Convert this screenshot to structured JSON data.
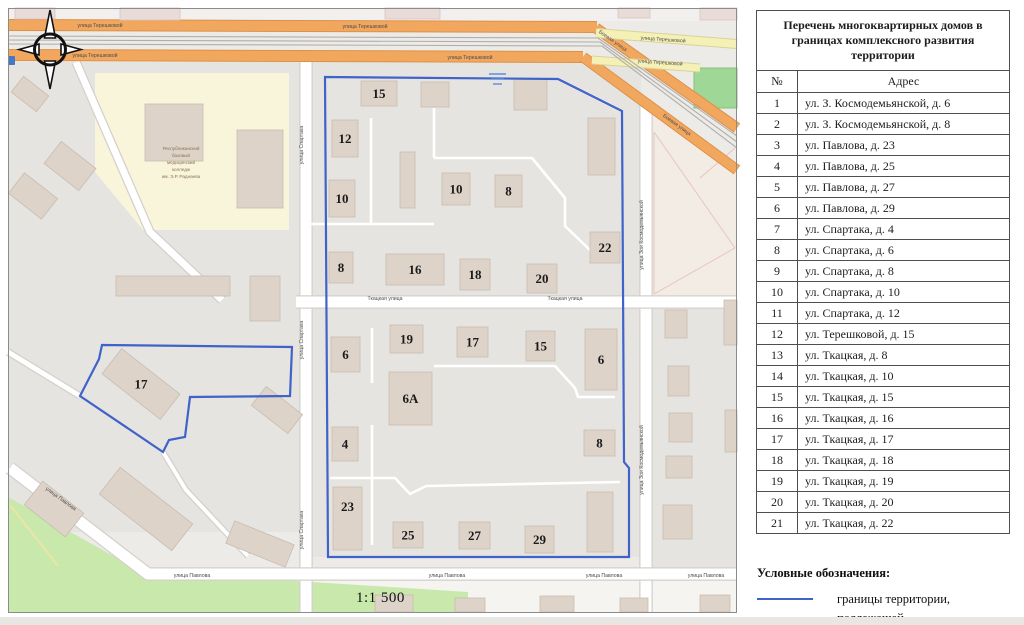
{
  "table": {
    "title": "Перечень многоквартирных домов в границах комплексного развития территории",
    "col_num": "№",
    "col_addr": "Адрес",
    "rows": [
      {
        "n": "1",
        "addr": "ул. З. Космодемьянской, д. 6"
      },
      {
        "n": "2",
        "addr": "ул. З. Космодемьянской, д. 8"
      },
      {
        "n": "3",
        "addr": "ул. Павлова, д. 23"
      },
      {
        "n": "4",
        "addr": "ул. Павлова, д. 25"
      },
      {
        "n": "5",
        "addr": "ул. Павлова, д. 27"
      },
      {
        "n": "6",
        "addr": "ул. Павлова, д. 29"
      },
      {
        "n": "7",
        "addr": "ул. Спартака, д. 4"
      },
      {
        "n": "8",
        "addr": "ул. Спартака, д. 6"
      },
      {
        "n": "9",
        "addr": "ул. Спартака, д. 8"
      },
      {
        "n": "10",
        "addr": "ул. Спартака, д. 10"
      },
      {
        "n": "11",
        "addr": "ул. Спартака, д. 12"
      },
      {
        "n": "12",
        "addr": "ул. Терешковой, д. 15"
      },
      {
        "n": "13",
        "addr": "ул. Ткацкая, д. 8"
      },
      {
        "n": "14",
        "addr": "ул. Ткацкая, д. 10"
      },
      {
        "n": "15",
        "addr": "ул. Ткацкая, д. 15"
      },
      {
        "n": "16",
        "addr": "ул. Ткацкая, д. 16"
      },
      {
        "n": "17",
        "addr": "ул. Ткацкая, д. 17"
      },
      {
        "n": "18",
        "addr": "ул. Ткацкая, д. 18"
      },
      {
        "n": "19",
        "addr": "ул. Ткацкая, д. 19"
      },
      {
        "n": "20",
        "addr": "ул. Ткацкая, д. 20"
      },
      {
        "n": "21",
        "addr": "ул. Ткацкая, д. 22"
      }
    ]
  },
  "legend": {
    "heading": "Условные обозначения:",
    "line1": "границы территории, подлежащей",
    "line2": "комплексному развитию",
    "boundary_color": "#3f63c9"
  },
  "map": {
    "scale_label": "1:1 500",
    "colors": {
      "base": "#edebe8",
      "residential": "#e6e4e1",
      "strip": "#f6f4f1",
      "topstrip": "#f2f0ee",
      "building": "#ddd3c9",
      "buildingStroke": "#c9bcb0",
      "buildingPink": "#e9dbd7",
      "pinkStroke": "#d9c6c2",
      "orange": "#f2a75f",
      "orangeCasing": "#dd9147",
      "yellow": "#f5f1b6",
      "yellowCasing": "#d8d398",
      "white": "#ffffff",
      "casing": "#d4d0cc",
      "rail": "#b1aeab",
      "green": "#c9e8ab",
      "pitch": "#9fd797",
      "collegeArea": "#f8f5da",
      "beige": "#f2ece5",
      "pinkLine": "#e6c3ba",
      "boundary": "#3f63c9",
      "streetLabel": "#4c4c4c",
      "number": "#1b1b1b",
      "collegeText": "#8a7354",
      "poiBlue": "#4576c8"
    },
    "residential": [
      [
        8,
        62,
        294,
        470
      ],
      [
        311,
        62,
        330,
        495
      ],
      [
        652,
        308,
        85,
        262
      ]
    ],
    "college": {
      "outline": [
        [
          95,
          73
        ],
        [
          289,
          73
        ],
        [
          289,
          230
        ],
        [
          143,
          230
        ],
        [
          95,
          172
        ]
      ],
      "label_lines": [
        "Республиканский",
        "базовый",
        "медицинский",
        "колледж",
        "им. Э.Р. Раднаева"
      ],
      "label_x": 181,
      "label_y": 150,
      "line_h": 7
    },
    "ne_area": {
      "outline": [
        [
          640,
          104
        ],
        [
          737,
          174
        ],
        [
          737,
          300
        ],
        [
          652,
          300
        ],
        [
          640,
          236
        ]
      ],
      "lines": [
        [
          [
            654,
            132
          ],
          [
            735,
            248
          ]
        ],
        [
          [
            654,
            294
          ],
          [
            735,
            248
          ]
        ],
        [
          [
            700,
            178
          ],
          [
            735,
            148
          ]
        ],
        [
          [
            654,
            132
          ],
          [
            654,
            294
          ]
        ]
      ]
    },
    "greens": {
      "park": [
        [
          8,
          497
        ],
        [
          140,
          571
        ],
        [
          468,
          592
        ],
        [
          468,
          613
        ],
        [
          8,
          613
        ]
      ],
      "pitch": [
        694,
        68,
        43,
        40
      ],
      "yellow_path": [
        [
          10,
          505
        ],
        [
          58,
          566
        ]
      ]
    },
    "white_streets": [
      {
        "pts": [
          [
            306,
            60
          ],
          [
            306,
            613
          ]
        ],
        "w": 11
      },
      {
        "pts": [
          [
            646,
            104
          ],
          [
            646,
            613
          ]
        ],
        "w": 11
      },
      {
        "pts": [
          [
            296,
            302
          ],
          [
            737,
            302
          ]
        ],
        "w": 11
      },
      {
        "pts": [
          [
            10,
            468
          ],
          [
            148,
            574
          ],
          [
            737,
            574
          ]
        ],
        "w": 11
      },
      {
        "pts": [
          [
            76,
            62
          ],
          [
            150,
            232
          ],
          [
            222,
            300
          ]
        ],
        "w": 7
      },
      {
        "pts": [
          [
            8,
            352
          ],
          [
            80,
            396
          ]
        ],
        "w": 5
      },
      {
        "pts": [
          [
            163,
            452
          ],
          [
            186,
            490
          ],
          [
            248,
            556
          ]
        ],
        "w": 4
      }
    ],
    "inner_paths": [
      [
        [
          310,
          224
        ],
        [
          434,
          224
        ]
      ],
      [
        [
          371,
          118
        ],
        [
          371,
          224
        ]
      ],
      [
        [
          434,
          108
        ],
        [
          434,
          158
        ]
      ],
      [
        [
          434,
          158
        ],
        [
          532,
          158
        ],
        [
          565,
          198
        ],
        [
          565,
          226
        ],
        [
          592,
          252
        ],
        [
          620,
          252
        ]
      ],
      [
        [
          434,
          366
        ],
        [
          555,
          366
        ],
        [
          575,
          388
        ],
        [
          578,
          397
        ],
        [
          615,
          397
        ]
      ],
      [
        [
          372,
          328
        ],
        [
          372,
          383
        ]
      ],
      [
        [
          372,
          425
        ],
        [
          372,
          545
        ]
      ],
      [
        [
          330,
          478
        ],
        [
          395,
          478
        ],
        [
          410,
          494
        ],
        [
          426,
          486
        ],
        [
          620,
          482
        ]
      ]
    ],
    "major_roads": [
      {
        "pts": [
          [
            8,
            25
          ],
          [
            597,
            27
          ]
        ],
        "w": 10,
        "t": "orange"
      },
      {
        "pts": [
          [
            8,
            55
          ],
          [
            583,
            57
          ]
        ],
        "w": 10,
        "t": "orange"
      },
      {
        "pts": [
          [
            596,
            28
          ],
          [
            737,
            128
          ]
        ],
        "w": 9,
        "t": "orange"
      },
      {
        "pts": [
          [
            583,
            57
          ],
          [
            737,
            170
          ]
        ],
        "w": 9,
        "t": "orange"
      },
      {
        "pts": [
          [
            596,
            33
          ],
          [
            737,
            44
          ]
        ],
        "w": 8,
        "t": "yellow"
      },
      {
        "pts": [
          [
            592,
            60
          ],
          [
            700,
            68
          ]
        ],
        "w": 7,
        "t": "yellow"
      }
    ],
    "railway": [
      [
        [
          8,
          36
        ],
        [
          598,
          38
        ],
        [
          737,
          136
        ]
      ],
      [
        [
          8,
          40
        ],
        [
          600,
          42
        ],
        [
          737,
          142
        ]
      ],
      [
        [
          8,
          44
        ],
        [
          602,
          46
        ],
        [
          737,
          148
        ]
      ]
    ],
    "buildings": [
      {
        "x": 361,
        "y": 81,
        "w": 36,
        "h": 25,
        "l": "15"
      },
      {
        "x": 421,
        "y": 82,
        "w": 28,
        "h": 25
      },
      {
        "x": 514,
        "y": 79,
        "w": 33,
        "h": 31
      },
      {
        "x": 332,
        "y": 120,
        "w": 26,
        "h": 37,
        "l": "12"
      },
      {
        "x": 400,
        "y": 152,
        "w": 15,
        "h": 56
      },
      {
        "x": 442,
        "y": 173,
        "w": 28,
        "h": 32,
        "l": "10"
      },
      {
        "x": 495,
        "y": 175,
        "w": 27,
        "h": 32,
        "l": "8"
      },
      {
        "x": 588,
        "y": 118,
        "w": 27,
        "h": 57
      },
      {
        "x": 329,
        "y": 180,
        "w": 26,
        "h": 37,
        "l": "10"
      },
      {
        "x": 590,
        "y": 232,
        "w": 30,
        "h": 31,
        "l": "22"
      },
      {
        "x": 329,
        "y": 252,
        "w": 24,
        "h": 31,
        "l": "8"
      },
      {
        "x": 386,
        "y": 254,
        "w": 58,
        "h": 31,
        "l": "16"
      },
      {
        "x": 460,
        "y": 259,
        "w": 30,
        "h": 31,
        "l": "18"
      },
      {
        "x": 527,
        "y": 264,
        "w": 30,
        "h": 29,
        "l": "20"
      },
      {
        "x": 331,
        "y": 337,
        "w": 29,
        "h": 35,
        "l": "6"
      },
      {
        "x": 390,
        "y": 325,
        "w": 33,
        "h": 28,
        "l": "19"
      },
      {
        "x": 457,
        "y": 327,
        "w": 31,
        "h": 30,
        "l": "17"
      },
      {
        "x": 526,
        "y": 331,
        "w": 29,
        "h": 30,
        "l": "15"
      },
      {
        "x": 585,
        "y": 329,
        "w": 32,
        "h": 61,
        "l": "6"
      },
      {
        "x": 389,
        "y": 372,
        "w": 43,
        "h": 53,
        "l": "6А"
      },
      {
        "x": 332,
        "y": 427,
        "w": 26,
        "h": 34,
        "l": "4"
      },
      {
        "x": 584,
        "y": 430,
        "w": 31,
        "h": 26,
        "l": "8"
      },
      {
        "x": 333,
        "y": 487,
        "w": 29,
        "h": 63,
        "l": "23",
        "ly": -12
      },
      {
        "x": 393,
        "y": 522,
        "w": 30,
        "h": 26,
        "l": "25"
      },
      {
        "x": 459,
        "y": 522,
        "w": 31,
        "h": 27,
        "l": "27"
      },
      {
        "x": 525,
        "y": 526,
        "w": 29,
        "h": 27,
        "l": "29"
      },
      {
        "x": 587,
        "y": 492,
        "w": 26,
        "h": 60
      },
      {
        "x": 104,
        "y": 368,
        "w": 74,
        "h": 32,
        "l": "17",
        "r": 38
      },
      {
        "x": 12,
        "y": 183,
        "w": 42,
        "h": 26,
        "r": 38
      },
      {
        "x": 48,
        "y": 152,
        "w": 44,
        "h": 28,
        "r": 38
      },
      {
        "x": 14,
        "y": 84,
        "w": 32,
        "h": 20,
        "r": 38
      },
      {
        "x": 116,
        "y": 276,
        "w": 114,
        "h": 20
      },
      {
        "x": 250,
        "y": 276,
        "w": 30,
        "h": 45
      },
      {
        "x": 28,
        "y": 494,
        "w": 52,
        "h": 30,
        "r": 38
      },
      {
        "x": 100,
        "y": 492,
        "w": 92,
        "h": 34,
        "r": 38
      },
      {
        "x": 228,
        "y": 532,
        "w": 64,
        "h": 24,
        "r": 22
      },
      {
        "x": 254,
        "y": 398,
        "w": 46,
        "h": 24,
        "r": 38
      },
      {
        "x": 145,
        "y": 104,
        "w": 58,
        "h": 57
      },
      {
        "x": 237,
        "y": 130,
        "w": 46,
        "h": 78
      },
      {
        "x": 665,
        "y": 310,
        "w": 22,
        "h": 28
      },
      {
        "x": 668,
        "y": 366,
        "w": 21,
        "h": 30
      },
      {
        "x": 669,
        "y": 413,
        "w": 23,
        "h": 29
      },
      {
        "x": 666,
        "y": 456,
        "w": 26,
        "h": 22
      },
      {
        "x": 663,
        "y": 505,
        "w": 29,
        "h": 34
      },
      {
        "x": 724,
        "y": 300,
        "w": 13,
        "h": 45
      },
      {
        "x": 725,
        "y": 410,
        "w": 12,
        "h": 42
      },
      {
        "x": 375,
        "y": 595,
        "w": 38,
        "h": 17
      },
      {
        "x": 455,
        "y": 598,
        "w": 30,
        "h": 14
      },
      {
        "x": 540,
        "y": 596,
        "w": 34,
        "h": 16
      },
      {
        "x": 620,
        "y": 598,
        "w": 28,
        "h": 14
      },
      {
        "x": 700,
        "y": 595,
        "w": 30,
        "h": 17
      },
      {
        "x": 15,
        "y": 8,
        "w": 40,
        "h": 11,
        "c": "pink"
      },
      {
        "x": 120,
        "y": 8,
        "w": 60,
        "h": 12,
        "c": "pink"
      },
      {
        "x": 385,
        "y": 8,
        "w": 55,
        "h": 11,
        "c": "pink"
      },
      {
        "x": 618,
        "y": 8,
        "w": 32,
        "h": 10,
        "c": "pink"
      },
      {
        "x": 700,
        "y": 8,
        "w": 37,
        "h": 12,
        "c": "pink"
      }
    ],
    "street_labels": [
      {
        "t": "улица Терешковой",
        "x": 100,
        "y": 27,
        "r": 0
      },
      {
        "t": "улица Терешковой",
        "x": 365,
        "y": 28,
        "r": 0
      },
      {
        "t": "улица Терешковой",
        "x": 95,
        "y": 57,
        "r": 0
      },
      {
        "t": "улица Терешковой",
        "x": 470,
        "y": 59,
        "r": 0
      },
      {
        "t": "улица Терешковой",
        "x": 663,
        "y": 41,
        "r": 4
      },
      {
        "t": "улица Терешковой",
        "x": 660,
        "y": 64,
        "r": 4
      },
      {
        "t": "Боевая улица",
        "x": 612,
        "y": 42,
        "r": 35
      },
      {
        "t": "Боевая улица",
        "x": 676,
        "y": 126,
        "r": 36
      },
      {
        "t": "улица Спартака",
        "x": 303,
        "y": 145,
        "r": -90
      },
      {
        "t": "улица Спартака",
        "x": 303,
        "y": 340,
        "r": -90
      },
      {
        "t": "улица Спартака",
        "x": 303,
        "y": 530,
        "r": -90
      },
      {
        "t": "улица Зои Космодемьянской",
        "x": 643,
        "y": 235,
        "r": -90
      },
      {
        "t": "улица Зои Космодемьянской",
        "x": 643,
        "y": 460,
        "r": -90
      },
      {
        "t": "Ткацкая улица",
        "x": 385,
        "y": 300,
        "r": 0
      },
      {
        "t": "Ткацкая улица",
        "x": 565,
        "y": 300,
        "r": 0
      },
      {
        "t": "улица Павлова",
        "x": 60,
        "y": 500,
        "r": 36
      },
      {
        "t": "улица Павлова",
        "x": 192,
        "y": 577,
        "r": 0
      },
      {
        "t": "улица Павлова",
        "x": 447,
        "y": 577,
        "r": 0
      },
      {
        "t": "улица Павлова",
        "x": 604,
        "y": 577,
        "r": 0
      },
      {
        "t": "улица Павлова",
        "x": 706,
        "y": 577,
        "r": 0
      }
    ],
    "boundaries": {
      "main": [
        [
          325,
          77
        ],
        [
          558,
          79
        ],
        [
          622,
          111
        ],
        [
          624,
          462
        ],
        [
          629,
          468
        ],
        [
          629,
          557
        ],
        [
          328,
          557
        ]
      ],
      "secondary": [
        [
          102,
          345
        ],
        [
          292,
          347
        ],
        [
          290,
          396
        ],
        [
          190,
          397
        ],
        [
          185,
          437
        ],
        [
          169,
          440
        ],
        [
          163,
          452
        ],
        [
          80,
          396
        ],
        [
          99,
          359
        ]
      ]
    }
  }
}
